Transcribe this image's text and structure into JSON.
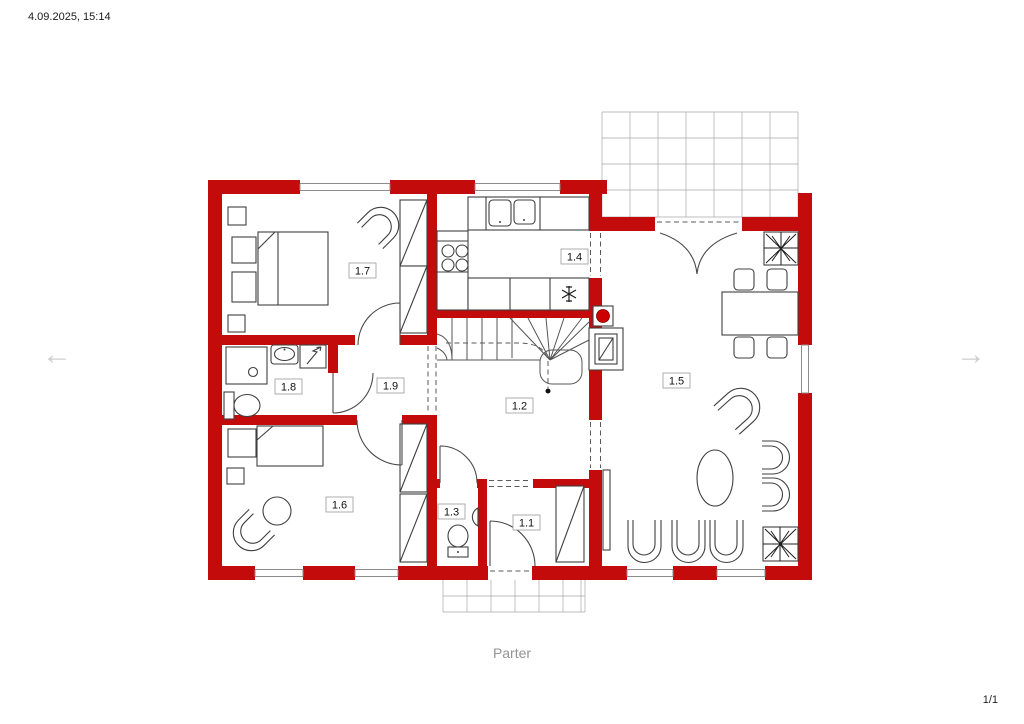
{
  "header": {
    "timestamp": "4.09.2025, 15:14"
  },
  "footer": {
    "caption": "Parter",
    "page_indicator": "1/1"
  },
  "navigation": {
    "prev_arrow": "←",
    "next_arrow": "→"
  },
  "plan": {
    "room_labels": [
      "1.1",
      "1.2",
      "1.3",
      "1.4",
      "1.5",
      "1.6",
      "1.7",
      "1.8",
      "1.9"
    ],
    "colors": {
      "wall_red": "#C30B0B",
      "chimney_red": "#CC0000",
      "furniture_line": "#3F3F3F",
      "grid_line": "#A8A8A8",
      "muted_text": "#949494"
    }
  }
}
